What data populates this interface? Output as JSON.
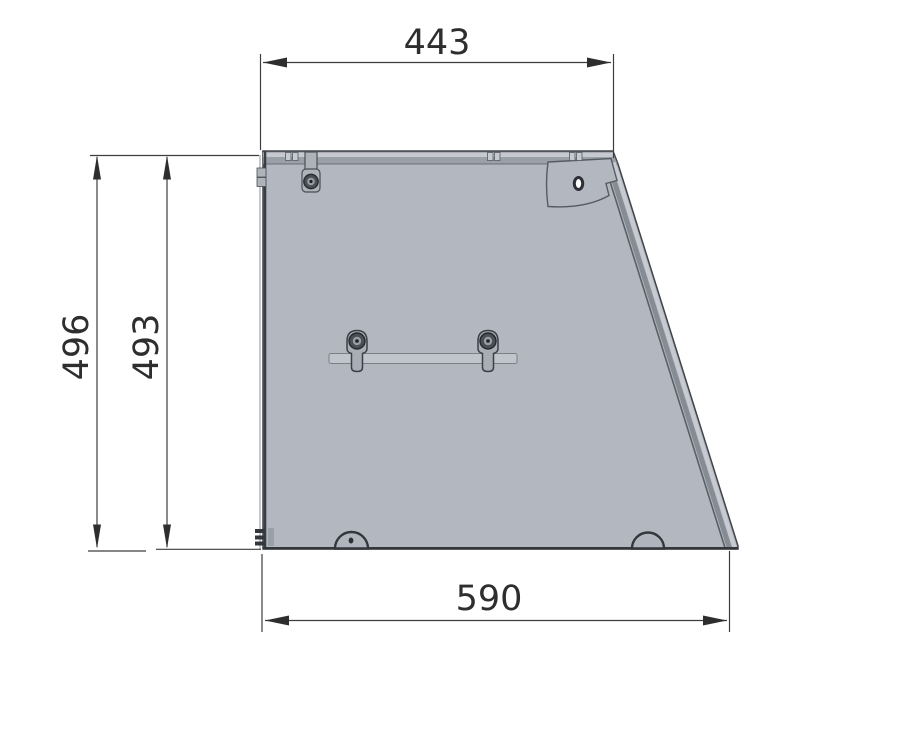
{
  "drawing": {
    "type": "technical-dimension-drawing",
    "view": "side-panel-of-enclosure",
    "dimensions": {
      "top_width": {
        "label": "443",
        "orientation": "horizontal",
        "position": "top"
      },
      "overall_height": {
        "label": "496",
        "orientation": "vertical",
        "position": "left-outer"
      },
      "panel_height": {
        "label": "493",
        "orientation": "vertical",
        "position": "left-inner"
      },
      "bottom_width": {
        "label": "590",
        "orientation": "horizontal",
        "position": "bottom"
      }
    },
    "colors": {
      "background": "#ffffff",
      "panel_fill": "#b3b7c0",
      "panel_light": "#c6cad0",
      "edge_strip": "#99a0a8",
      "outline": "#3f444a",
      "dimension_line": "#3d3d3d",
      "dimension_text": "#2e2e2e"
    }
  }
}
